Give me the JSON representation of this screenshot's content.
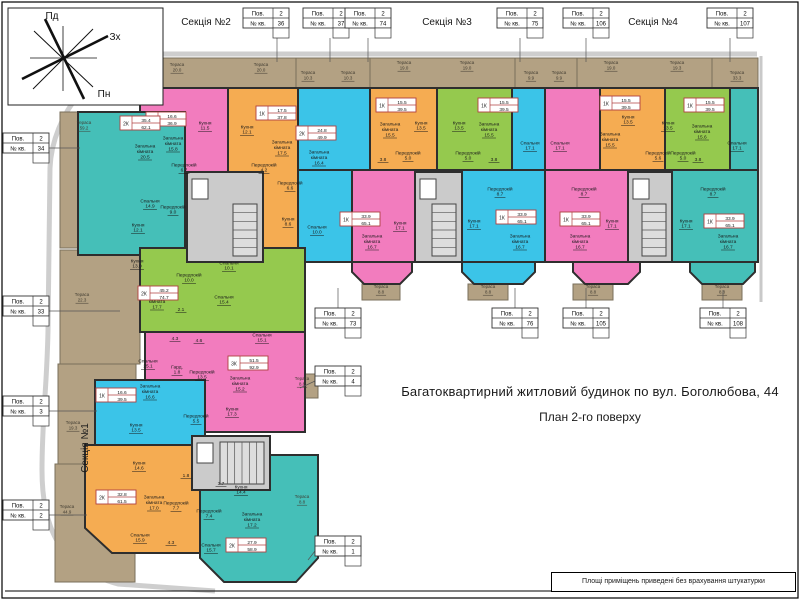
{
  "header": {
    "title": "Багатоквартирний житловий будинок по вул. Боголюбова, 44",
    "subtitle": "План 2-го поверху"
  },
  "footer": {
    "note": "Площі приміщень приведені без врахування штукатурки"
  },
  "compass": {
    "south": "Пд",
    "west": "Зх",
    "north": "Пн"
  },
  "labels": {
    "floor": "Пов.",
    "floor_value": "2",
    "apt": "№ кв.",
    "terrace": "Тераса"
  },
  "colors": {
    "pink": "#F27CBE",
    "orange": "#F5AC52",
    "cyan": "#3BC4E8",
    "green": "#95C94E",
    "teal": "#45BFB8",
    "tan": "#B3A183",
    "core": "#CBCBCB",
    "wall": "#2E2E2E",
    "tanline": "#7a6f5b",
    "leader": "#555555",
    "red_table": "#B04040",
    "sidewalk": "#C9C9C9"
  },
  "sections": [
    {
      "label": "Секція №2",
      "x": 206,
      "y": 25,
      "rot": 0
    },
    {
      "label": "Секція №3",
      "x": 447,
      "y": 25,
      "rot": 0
    },
    {
      "label": "Секція №4",
      "x": 653,
      "y": 25,
      "rot": 0
    },
    {
      "label": "Секція №1",
      "x": 88,
      "y": 448,
      "rot": -90
    }
  ],
  "apt_tables": [
    {
      "num": "35",
      "x": 111,
      "y": 8,
      "leader": [
        148,
        38,
        148,
        70
      ]
    },
    {
      "num": "36",
      "x": 243,
      "y": 8,
      "leader": [
        277,
        38,
        277,
        62
      ]
    },
    {
      "num": "37",
      "x": 303,
      "y": 8,
      "leader": [
        330,
        38,
        330,
        62
      ]
    },
    {
      "num": "74",
      "x": 345,
      "y": 8,
      "leader": [
        368,
        38,
        368,
        62
      ]
    },
    {
      "num": "75",
      "x": 497,
      "y": 8,
      "leader": [
        520,
        38,
        520,
        62
      ]
    },
    {
      "num": "106",
      "x": 563,
      "y": 8,
      "leader": [
        586,
        38,
        586,
        62
      ]
    },
    {
      "num": "107",
      "x": 707,
      "y": 8,
      "leader": [
        730,
        38,
        730,
        62
      ]
    },
    {
      "num": "34",
      "x": 3,
      "y": 133,
      "leader": [
        49,
        148,
        80,
        148
      ]
    },
    {
      "num": "33",
      "x": 3,
      "y": 296,
      "leader": [
        49,
        311,
        120,
        311
      ]
    },
    {
      "num": "3",
      "x": 3,
      "y": 396,
      "leader": [
        49,
        411,
        97,
        411
      ]
    },
    {
      "num": "2",
      "x": 3,
      "y": 500,
      "leader": [
        49,
        515,
        87,
        515
      ]
    },
    {
      "num": "4",
      "x": 315,
      "y": 366,
      "leader": [
        315,
        381,
        300,
        388
      ]
    },
    {
      "num": "1",
      "x": 315,
      "y": 536,
      "leader": [
        315,
        551,
        308,
        560
      ]
    },
    {
      "num": "73",
      "x": 315,
      "y": 308,
      "leader": [
        338,
        308,
        338,
        288
      ]
    },
    {
      "num": "76",
      "x": 492,
      "y": 308,
      "leader": [
        515,
        308,
        515,
        288
      ]
    },
    {
      "num": "105",
      "x": 563,
      "y": 308,
      "leader": [
        586,
        308,
        586,
        288
      ]
    },
    {
      "num": "108",
      "x": 700,
      "y": 308,
      "leader": [
        723,
        308,
        723,
        290
      ]
    }
  ],
  "plan": {
    "terrace_rects": [
      {
        "x": 140,
        "y": 58,
        "w": 618,
        "h": 30
      },
      {
        "x": 296,
        "y": 58,
        "w": 74,
        "h": 42
      },
      {
        "x": 515,
        "y": 58,
        "w": 62,
        "h": 42
      },
      {
        "x": 712,
        "y": 58,
        "w": 46,
        "h": 50
      },
      {
        "x": 60,
        "y": 112,
        "w": 76,
        "h": 136
      },
      {
        "x": 60,
        "y": 250,
        "w": 80,
        "h": 114
      },
      {
        "x": 58,
        "y": 364,
        "w": 78,
        "h": 100
      },
      {
        "x": 55,
        "y": 464,
        "w": 80,
        "h": 118
      },
      {
        "x": 362,
        "y": 284,
        "w": 38,
        "h": 16
      },
      {
        "x": 468,
        "y": 284,
        "w": 40,
        "h": 16
      },
      {
        "x": 573,
        "y": 284,
        "w": 40,
        "h": 16
      },
      {
        "x": 702,
        "y": 284,
        "w": 40,
        "h": 16
      },
      {
        "x": 286,
        "y": 374,
        "w": 32,
        "h": 24
      },
      {
        "x": 286,
        "y": 492,
        "w": 32,
        "h": 24
      }
    ],
    "terrace_labels": [
      {
        "x": 177,
        "y": 66,
        "a": "20.0"
      },
      {
        "x": 261,
        "y": 66,
        "a": "20.0"
      },
      {
        "x": 308,
        "y": 74,
        "a": "10.3"
      },
      {
        "x": 348,
        "y": 74,
        "a": "10.3"
      },
      {
        "x": 404,
        "y": 64,
        "a": "19.0"
      },
      {
        "x": 467,
        "y": 64,
        "a": "19.0"
      },
      {
        "x": 531,
        "y": 74,
        "a": "9.9"
      },
      {
        "x": 559,
        "y": 74,
        "a": "9.9"
      },
      {
        "x": 611,
        "y": 64,
        "a": "19.0"
      },
      {
        "x": 677,
        "y": 64,
        "a": "19.3"
      },
      {
        "x": 737,
        "y": 74,
        "a": "33.3"
      },
      {
        "x": 84,
        "y": 124,
        "a": "59.2"
      },
      {
        "x": 82,
        "y": 296,
        "a": "22.3"
      },
      {
        "x": 73,
        "y": 424,
        "a": "19.3"
      },
      {
        "x": 67,
        "y": 508,
        "a": "44.9"
      },
      {
        "x": 381,
        "y": 288,
        "a": "8.8"
      },
      {
        "x": 488,
        "y": 288,
        "a": "8.8"
      },
      {
        "x": 593,
        "y": 288,
        "a": "8.8"
      },
      {
        "x": 722,
        "y": 288,
        "a": "8.8"
      },
      {
        "x": 302,
        "y": 380,
        "a": "8.8"
      },
      {
        "x": 302,
        "y": 498,
        "a": "8.8"
      }
    ],
    "blocks": [
      {
        "x": 140,
        "y": 88,
        "w": 88,
        "h": 174,
        "c": "pink"
      },
      {
        "x": 228,
        "y": 88,
        "w": 70,
        "h": 174,
        "c": "orange"
      },
      {
        "x": 298,
        "y": 88,
        "w": 72,
        "h": 82,
        "c": "cyan"
      },
      {
        "x": 298,
        "y": 170,
        "w": 54,
        "h": 92,
        "c": "cyan"
      },
      {
        "x": 352,
        "y": 170,
        "w": 63,
        "h": 92,
        "c": "pink"
      },
      {
        "x": 370,
        "y": 88,
        "w": 67,
        "h": 82,
        "c": "orange"
      },
      {
        "x": 437,
        "y": 88,
        "w": 75,
        "h": 82,
        "c": "green"
      },
      {
        "x": 512,
        "y": 88,
        "w": 33,
        "h": 82,
        "c": "cyan"
      },
      {
        "x": 462,
        "y": 170,
        "w": 83,
        "h": 92,
        "c": "cyan"
      },
      {
        "x": 545,
        "y": 88,
        "w": 55,
        "h": 82,
        "c": "pink"
      },
      {
        "x": 545,
        "y": 170,
        "w": 83,
        "h": 92,
        "c": "pink"
      },
      {
        "x": 600,
        "y": 88,
        "w": 65,
        "h": 82,
        "c": "orange"
      },
      {
        "x": 665,
        "y": 88,
        "w": 65,
        "h": 82,
        "c": "green"
      },
      {
        "x": 730,
        "y": 88,
        "w": 28,
        "h": 82,
        "c": "teal"
      },
      {
        "x": 672,
        "y": 170,
        "w": 86,
        "h": 92,
        "c": "teal"
      },
      {
        "x": 78,
        "y": 112,
        "w": 107,
        "h": 143,
        "c": "teal"
      },
      {
        "x": 140,
        "y": 248,
        "w": 165,
        "h": 84,
        "c": "green"
      },
      {
        "x": 145,
        "y": 332,
        "w": 160,
        "h": 100,
        "c": "pink"
      },
      {
        "x": 95,
        "y": 380,
        "w": 110,
        "h": 65,
        "c": "cyan"
      }
    ],
    "polys": [
      {
        "pts": "85,445 235,445 235,553 112,553 85,528",
        "c": "orange"
      },
      {
        "pts": "200,455 318,455 318,558 296,582 224,582 200,558",
        "c": "teal"
      },
      {
        "pts": "352,262 412,262 412,272 400,284 364,284 352,272",
        "c": "pink"
      },
      {
        "pts": "462,262 535,262 535,272 523,284 474,284 462,272",
        "c": "cyan"
      },
      {
        "pts": "573,262 640,262 640,272 628,284 585,284 573,272",
        "c": "pink"
      },
      {
        "pts": "690,262 755,262 755,272 743,284 702,284 690,272",
        "c": "teal"
      }
    ],
    "cores": [
      {
        "x": 187,
        "y": 172,
        "w": 76,
        "h": 90
      },
      {
        "x": 415,
        "y": 172,
        "w": 47,
        "h": 90
      },
      {
        "x": 628,
        "y": 172,
        "w": 44,
        "h": 90
      },
      {
        "x": 192,
        "y": 436,
        "w": 78,
        "h": 54
      }
    ],
    "rooms": [
      {
        "n": "Кухня",
        "a": "11.5",
        "x": 205,
        "y": 124
      },
      {
        "n": "Загальна кімната",
        "a": "15.8",
        "x": 173,
        "y": 142
      },
      {
        "n": "Передпокій",
        "a": "6.7",
        "x": 184,
        "y": 166
      },
      {
        "n": "Кухня",
        "a": "12.1",
        "x": 247,
        "y": 128
      },
      {
        "n": "Загальна кімната",
        "a": "17.5",
        "x": 282,
        "y": 146
      },
      {
        "n": "Передпокій",
        "a": "4.2",
        "x": 264,
        "y": 166
      },
      {
        "n": "Загальна кімната",
        "a": "16.4",
        "x": 319,
        "y": 156
      },
      {
        "n": "Передпокій",
        "a": "6.6",
        "x": 290,
        "y": 184
      },
      {
        "n": "Кухня",
        "a": "8.6",
        "x": 288,
        "y": 220
      },
      {
        "n": "Спальня",
        "a": "10.0",
        "x": 317,
        "y": 228
      },
      {
        "n": "Кухня",
        "a": "17.1",
        "x": 400,
        "y": 224
      },
      {
        "n": "Загальна кімната",
        "a": "16.7",
        "x": 372,
        "y": 240
      },
      {
        "n": "Загальна кімната",
        "a": "15.5",
        "x": 390,
        "y": 128
      },
      {
        "n": "Кухня",
        "a": "13.5",
        "x": 421,
        "y": 124
      },
      {
        "n": "Передпокій",
        "a": "5.0",
        "x": 408,
        "y": 154
      },
      {
        "n": "",
        "a": "3.8",
        "x": 383,
        "y": 158
      },
      {
        "n": "Кухня",
        "a": "13.5",
        "x": 459,
        "y": 124
      },
      {
        "n": "Загальна кімната",
        "a": "15.5",
        "x": 489,
        "y": 128
      },
      {
        "n": "Передпокій",
        "a": "5.0",
        "x": 468,
        "y": 154
      },
      {
        "n": "",
        "a": "3.8",
        "x": 494,
        "y": 158
      },
      {
        "n": "Спальня",
        "a": "17.1",
        "x": 530,
        "y": 144
      },
      {
        "n": "Передпокій",
        "a": "8.7",
        "x": 500,
        "y": 190
      },
      {
        "n": "Кухня",
        "a": "17.1",
        "x": 474,
        "y": 222
      },
      {
        "n": "Загальна кімната",
        "a": "16.7",
        "x": 520,
        "y": 240
      },
      {
        "n": "Спальня",
        "a": "17.1",
        "x": 560,
        "y": 144
      },
      {
        "n": "Передпокій",
        "a": "8.7",
        "x": 584,
        "y": 190
      },
      {
        "n": "Загальна кімната",
        "a": "16.7",
        "x": 580,
        "y": 240
      },
      {
        "n": "Кухня",
        "a": "17.1",
        "x": 612,
        "y": 222
      },
      {
        "n": "Кухня",
        "a": "13.5",
        "x": 628,
        "y": 118
      },
      {
        "n": "Загальна кімната",
        "a": "15.5",
        "x": 610,
        "y": 138
      },
      {
        "n": "Передпокій",
        "a": "5.6",
        "x": 658,
        "y": 154
      },
      {
        "n": "Кухня",
        "a": "13.5",
        "x": 668,
        "y": 124
      },
      {
        "n": "Загальна кімната",
        "a": "15.6",
        "x": 702,
        "y": 130
      },
      {
        "n": "Передпокій",
        "a": "5.0",
        "x": 683,
        "y": 154
      },
      {
        "n": "",
        "a": "3.8",
        "x": 698,
        "y": 158
      },
      {
        "n": "Спальня",
        "a": "17.1",
        "x": 737,
        "y": 144
      },
      {
        "n": "Передпокій",
        "a": "8.7",
        "x": 713,
        "y": 190
      },
      {
        "n": "Кухня",
        "a": "17.1",
        "x": 686,
        "y": 222
      },
      {
        "n": "Загальна кімната",
        "a": "16.7",
        "x": 728,
        "y": 240
      },
      {
        "n": "Загальна кімната",
        "a": "20.5",
        "x": 145,
        "y": 150
      },
      {
        "n": "Спальня",
        "a": "14.9",
        "x": 150,
        "y": 202
      },
      {
        "n": "Кухня",
        "a": "12.1",
        "x": 138,
        "y": 226
      },
      {
        "n": "Передпокій",
        "a": "9.0",
        "x": 173,
        "y": 208
      },
      {
        "n": "Кухня",
        "a": "13.0",
        "x": 137,
        "y": 262
      },
      {
        "n": "Передпокій",
        "a": "10.0",
        "x": 189,
        "y": 276
      },
      {
        "n": "Спальня",
        "a": "10.1",
        "x": 229,
        "y": 264
      },
      {
        "n": "Спальня",
        "a": "15.4",
        "x": 224,
        "y": 298
      },
      {
        "n": "Загальна кімната",
        "a": "17.7",
        "x": 157,
        "y": 300
      },
      {
        "n": "",
        "a": "2.1",
        "x": 181,
        "y": 308
      },
      {
        "n": "Спальня",
        "a": "25.1",
        "x": 148,
        "y": 362
      },
      {
        "n": "Гард.",
        "a": "1.8",
        "x": 177,
        "y": 368
      },
      {
        "n": "Передпокій",
        "a": "13.5",
        "x": 202,
        "y": 373
      },
      {
        "n": "Загальна кімната",
        "a": "15.2",
        "x": 240,
        "y": 382
      },
      {
        "n": "Кухня",
        "a": "17.3",
        "x": 232,
        "y": 410
      },
      {
        "n": "Спальня",
        "a": "15.1",
        "x": 262,
        "y": 336
      },
      {
        "n": "",
        "a": "4.3",
        "x": 175,
        "y": 337
      },
      {
        "n": "",
        "a": "4.6",
        "x": 199,
        "y": 339
      },
      {
        "n": "Загальна кімната",
        "a": "16.6",
        "x": 150,
        "y": 390
      },
      {
        "n": "Кухня",
        "a": "13.5",
        "x": 136,
        "y": 426
      },
      {
        "n": "Передпокій",
        "a": "5.5",
        "x": 196,
        "y": 417
      },
      {
        "n": "Кухня",
        "a": "14.6",
        "x": 139,
        "y": 464
      },
      {
        "n": "Загальна кімната",
        "a": "17.0",
        "x": 154,
        "y": 501
      },
      {
        "n": "Спальня",
        "a": "15.9",
        "x": 140,
        "y": 536
      },
      {
        "n": "Передпокій",
        "a": "7.7",
        "x": 176,
        "y": 504
      },
      {
        "n": "",
        "a": "1.8",
        "x": 186,
        "y": 474
      },
      {
        "n": "",
        "a": "4.3",
        "x": 171,
        "y": 541
      },
      {
        "n": "Кухня",
        "a": "14.4",
        "x": 241,
        "y": 488
      },
      {
        "n": "",
        "a": "3.7",
        "x": 221,
        "y": 482
      },
      {
        "n": "Передпокій",
        "a": "7.4",
        "x": 209,
        "y": 512
      },
      {
        "n": "Загальна кімната",
        "a": "17.2",
        "x": 252,
        "y": 518
      },
      {
        "n": "Спальня",
        "a": "15.7",
        "x": 211,
        "y": 546
      }
    ],
    "area_tables": [
      {
        "t": "1К",
        "l": "16.6",
        "tt": "36.9",
        "x": 146,
        "y": 112
      },
      {
        "t": "1К",
        "l": "17.5",
        "tt": "37.8",
        "x": 256,
        "y": 106
      },
      {
        "t": "2К",
        "l": "24.8",
        "tt": "49.9",
        "x": 296,
        "y": 126
      },
      {
        "t": "1К",
        "l": "33.9",
        "tt": "65.1",
        "x": 340,
        "y": 212
      },
      {
        "t": "1К",
        "l": "15.5",
        "tt": "39.5",
        "x": 376,
        "y": 98
      },
      {
        "t": "1К",
        "l": "15.5",
        "tt": "39.5",
        "x": 478,
        "y": 98
      },
      {
        "t": "1К",
        "l": "33.9",
        "tt": "65.1",
        "x": 496,
        "y": 210
      },
      {
        "t": "1К",
        "l": "33.9",
        "tt": "65.1",
        "x": 560,
        "y": 212
      },
      {
        "t": "1К",
        "l": "15.5",
        "tt": "39.5",
        "x": 600,
        "y": 96
      },
      {
        "t": "1К",
        "l": "15.5",
        "tt": "39.5",
        "x": 684,
        "y": 98
      },
      {
        "t": "1К",
        "l": "33.9",
        "tt": "65.1",
        "x": 704,
        "y": 214
      },
      {
        "t": "2К",
        "l": "35.4",
        "tt": "62.1",
        "x": 120,
        "y": 116
      },
      {
        "t": "2К",
        "l": "45.2",
        "tt": "74.7",
        "x": 138,
        "y": 286
      },
      {
        "t": "3К",
        "l": "51.5",
        "tt": "92.9",
        "x": 228,
        "y": 356
      },
      {
        "t": "1К",
        "l": "16.6",
        "tt": "39.5",
        "x": 96,
        "y": 388
      },
      {
        "t": "2К",
        "l": "32.8",
        "tt": "61.5",
        "x": 96,
        "y": 490
      },
      {
        "t": "2К",
        "l": "27.9",
        "tt": "58.9",
        "x": 226,
        "y": 538
      }
    ]
  }
}
